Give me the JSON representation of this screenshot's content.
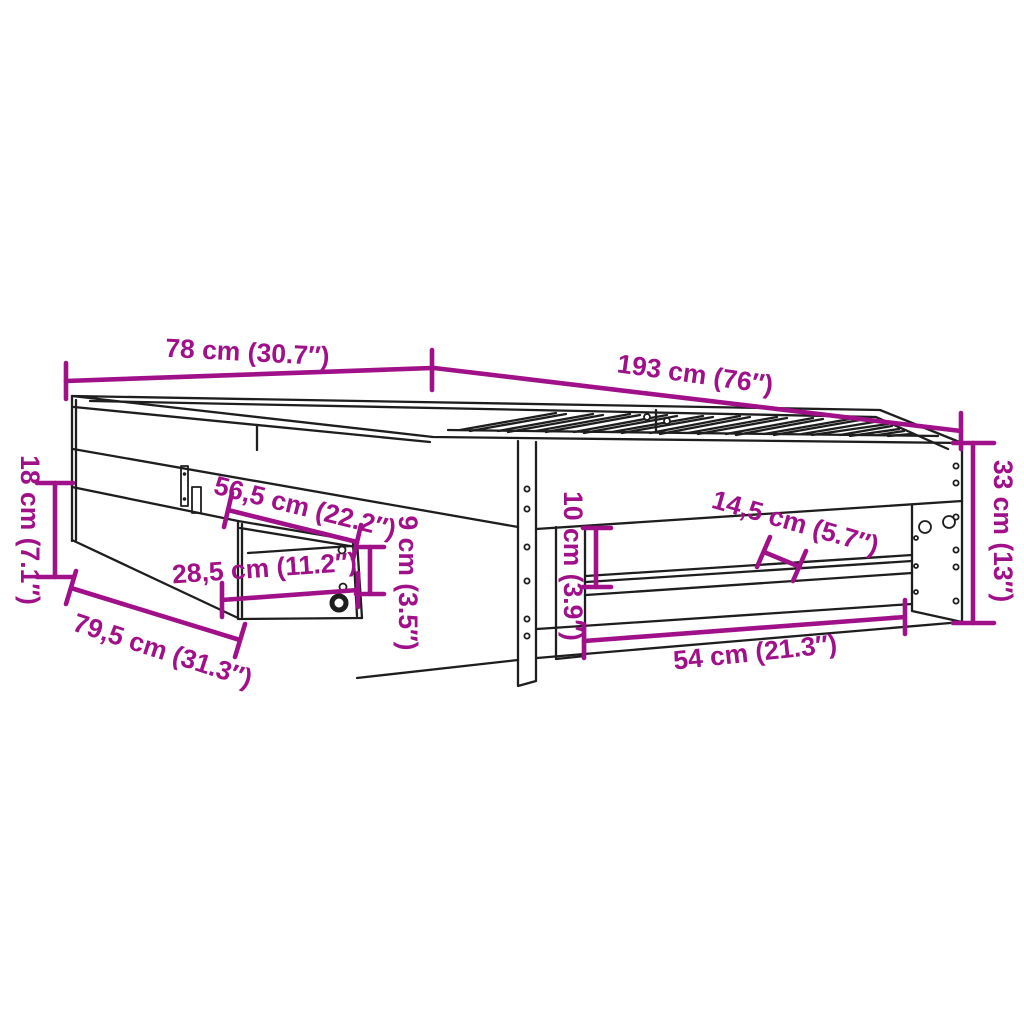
{
  "diagram": {
    "type": "furniture-dimension-line-drawing",
    "subject": "bed frame with pull-out drawer, slatted base and under-bed shelves",
    "colors": {
      "background": "#ffffff",
      "drawing_lines": "#1e1e1e",
      "dimension_accent": "#a01089"
    }
  },
  "dimensions": {
    "bed_width": "78 cm (30.7″)",
    "bed_length": "193 cm (76″)",
    "frame_height": "33 cm (13″)",
    "drawer_height": "18 cm (7.1″)",
    "drawer_width": "56,5 cm (22.2″)",
    "drawer_front_width": "28,5 cm (11.2″)",
    "drawer_depth": "79,5 cm (31.3″)",
    "drawer_inner_height": "9 cm (3.5″)",
    "side_rail_height": "10 cm (3.9″)",
    "shelf_depth": "14,5 cm (5.7″)",
    "bottom_opening_width": "54 cm (21.3″)"
  }
}
